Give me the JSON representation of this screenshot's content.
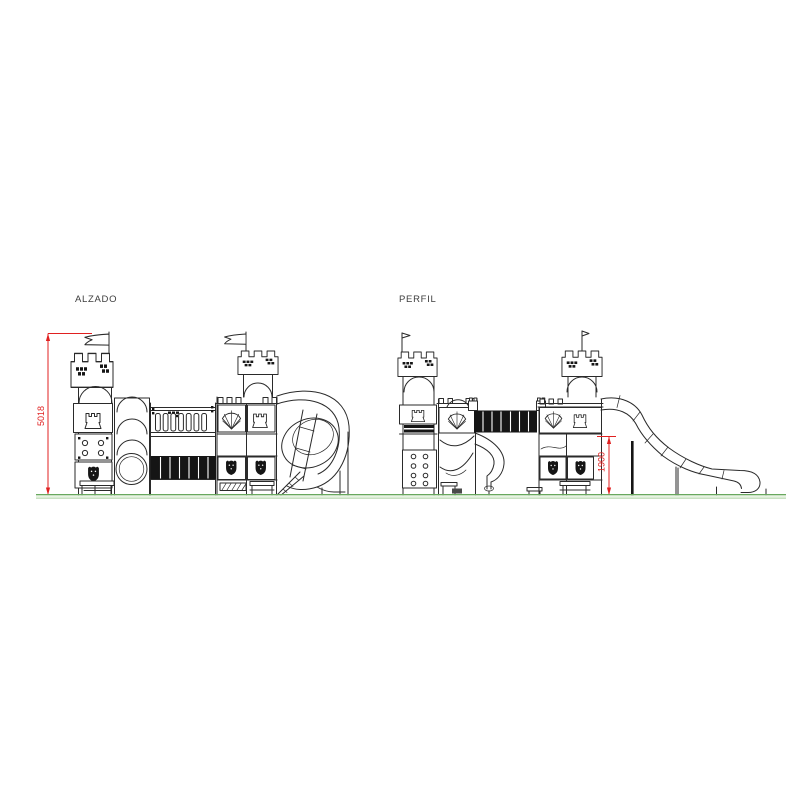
{
  "drawing": {
    "views": {
      "alzado": {
        "label": "ALZADO"
      },
      "perfil": {
        "label": "PERFIL"
      }
    },
    "dimensions": {
      "overall_height": {
        "value": "5018"
      },
      "platform_height": {
        "value": "1900"
      }
    },
    "colors": {
      "line": "#2a2a2a",
      "dimension": "#e02020",
      "ground": "#69a85f",
      "ground_fill": "#e8f3e3",
      "panel": "#151515"
    },
    "elements": {
      "alzado": [
        "flag-pennant",
        "battlement-tower",
        "rook-emblem",
        "climbing-panel",
        "shield-emblem",
        "access-bench",
        "crawl-tube",
        "palisade-bridge",
        "deck-panel",
        "shell-emblem",
        "spiral-tube-slide",
        "slide-steps"
      ],
      "perfil": [
        "flag-pennant",
        "battlement-tower",
        "rook-emblem",
        "climbing-wall",
        "shell-emblem",
        "tube-bridge",
        "curved-slide",
        "shield-emblem",
        "wave-slide",
        "slide-supports",
        "bench"
      ],
      "shared": [
        "ground-line"
      ]
    }
  }
}
